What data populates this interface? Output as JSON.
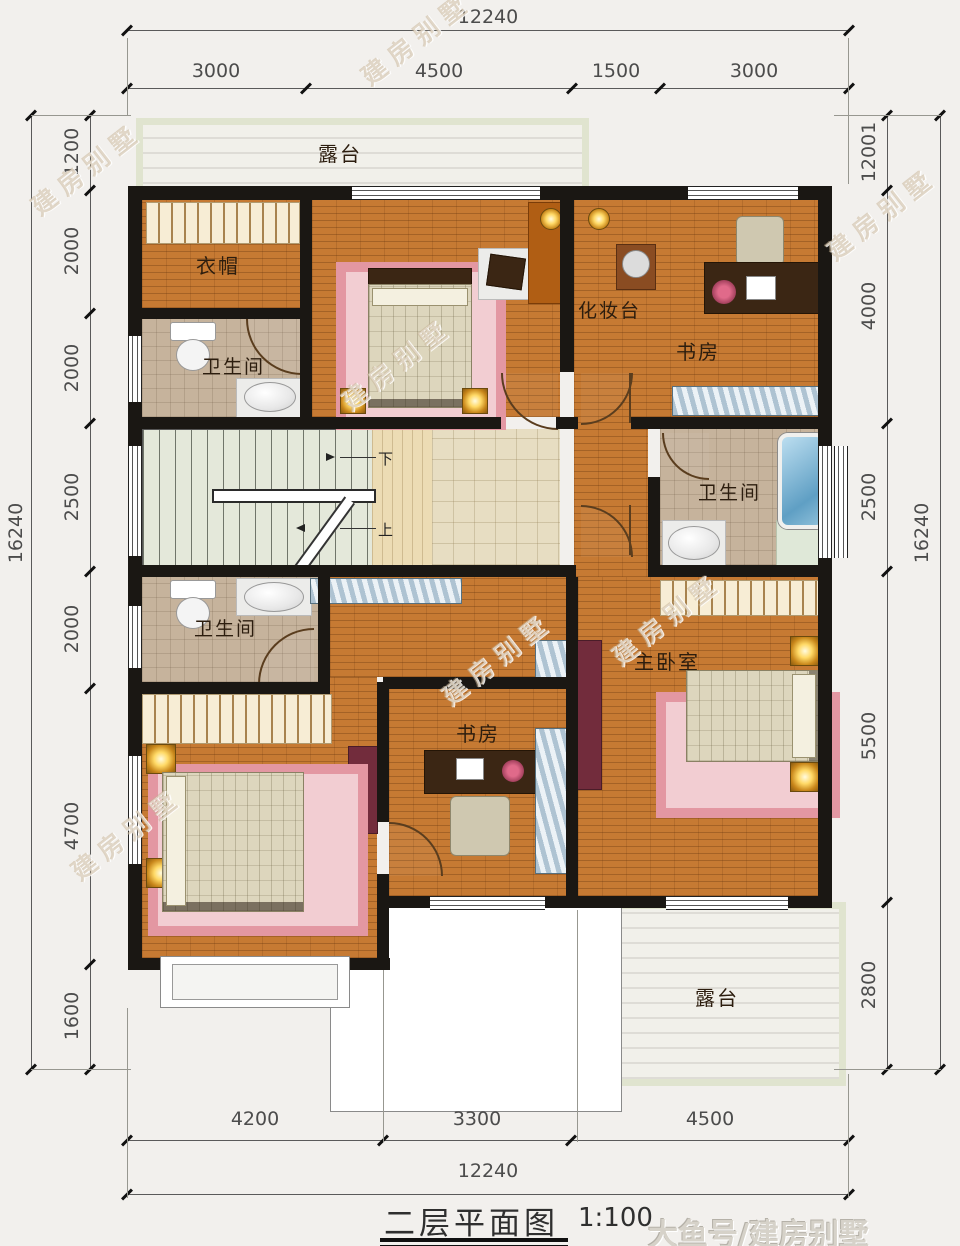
{
  "title": {
    "text": "二层平面图",
    "scale": "1:100"
  },
  "watermark": {
    "corner": "大鱼号/建房别墅",
    "diagonal": "建房别墅"
  },
  "dimensions": {
    "top": {
      "total": "12240",
      "segments": [
        "3000",
        "4500",
        "1500",
        "3000"
      ]
    },
    "bottom": {
      "total": "12240",
      "segments": [
        "4200",
        "3300",
        "4500"
      ]
    },
    "left": {
      "total": "16240",
      "segments": [
        "1200",
        "2000",
        "2000",
        "2500",
        "2000",
        "4700",
        "1600"
      ]
    },
    "right": {
      "total": "16240",
      "segments": [
        "12001",
        "4000",
        "2500",
        "5500",
        "2800"
      ]
    }
  },
  "rooms": {
    "terrace_top": "露台",
    "cloakroom": "衣帽",
    "bathroom_upper_left": "卫生间",
    "dressing_table": "化妆台",
    "study_upper": "书房",
    "bathroom_right": "卫生间",
    "bathroom_lower_left": "卫生间",
    "master_bedroom": "主卧室",
    "bedroom": "卧室",
    "study_lower": "书房",
    "terrace_bottom": "露台"
  },
  "stairs": {
    "down": "下",
    "up": "上"
  },
  "colors": {
    "wall": "#1a1713",
    "wood_floor": "#c67a33",
    "hall_tile": "#e7ddc2",
    "bath_floor": "#c6b39c",
    "rug_pink": "#e397a2",
    "terrace_border": "#e0e4cf",
    "tub_blue": "#5f9fc4"
  }
}
